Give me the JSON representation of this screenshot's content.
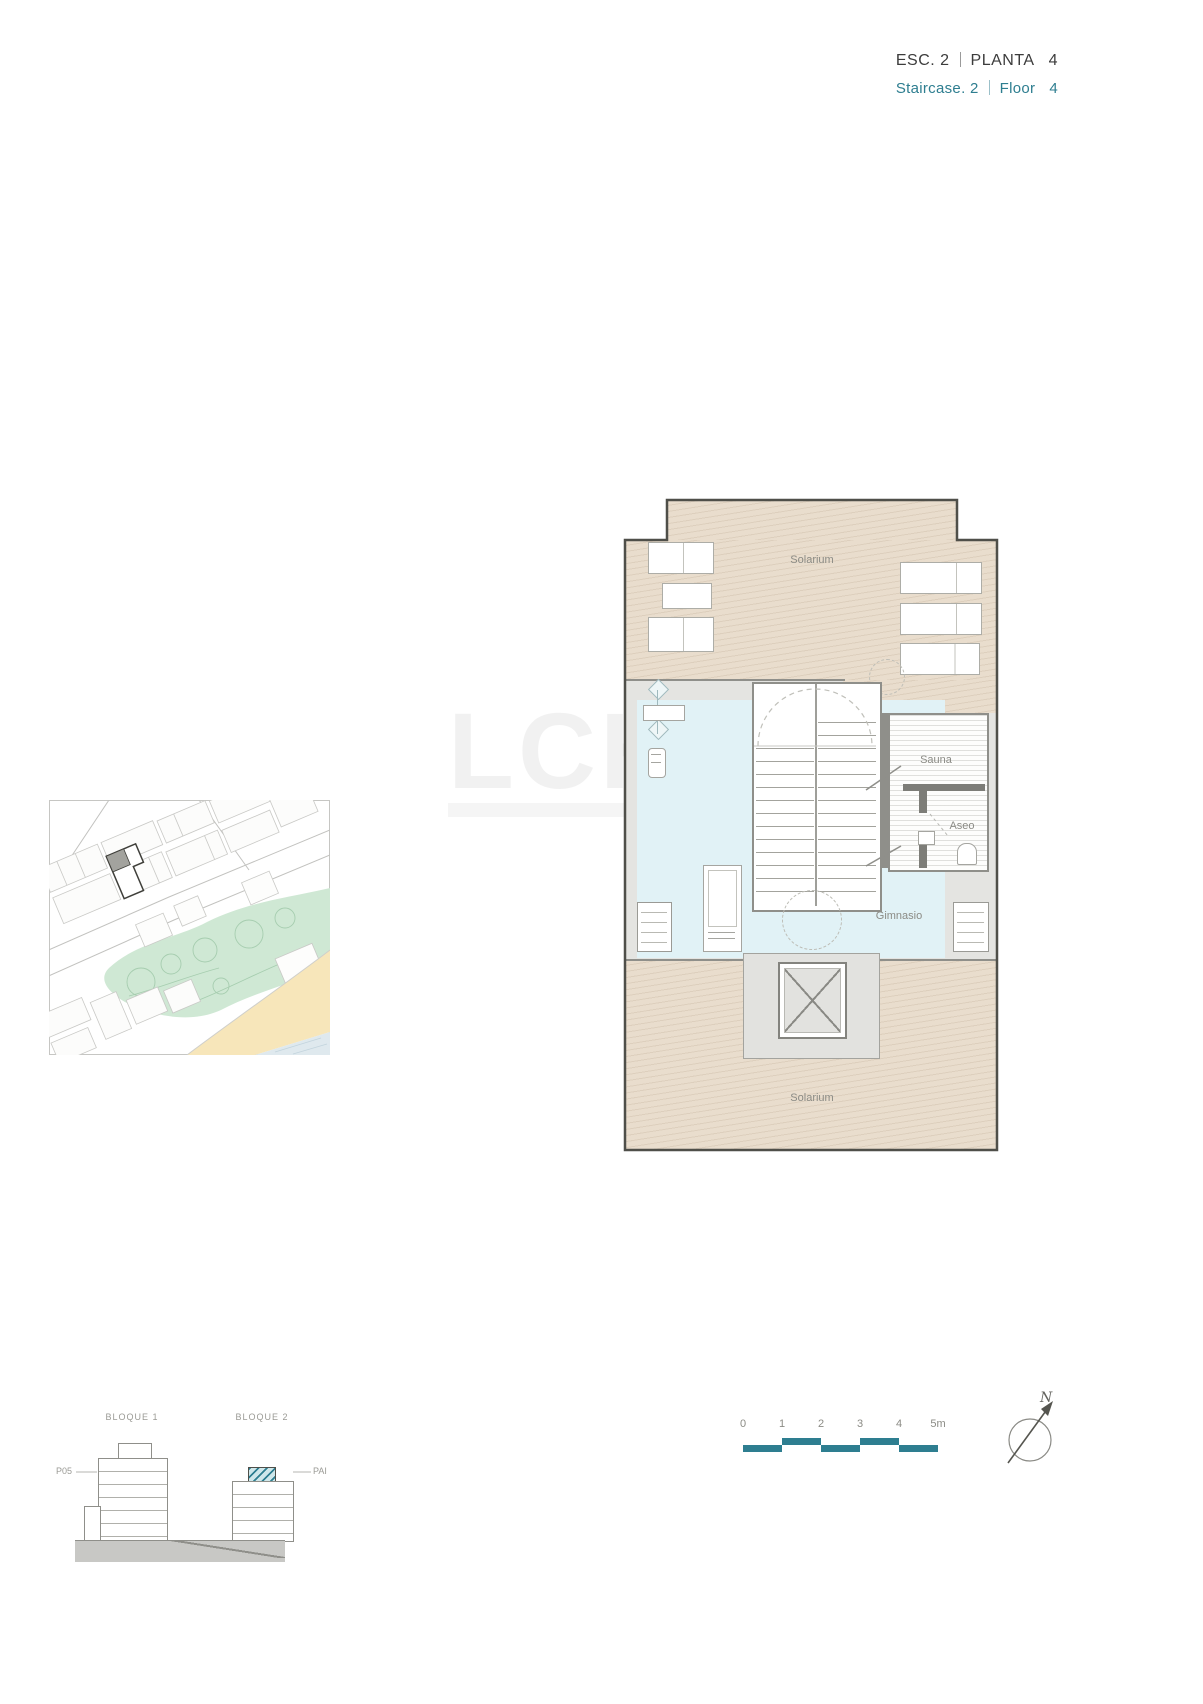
{
  "header": {
    "esc_label": "ESC. 2",
    "planta_label": "PLANTA",
    "planta_number": "4",
    "staircase_label": "Staircase. 2",
    "floor_label": "Floor",
    "floor_number": "4",
    "accent_color": "#2e7e90"
  },
  "floor_plan": {
    "rooms": {
      "solarium_top": "Solarium",
      "sauna": "Sauna",
      "aseo": "Aseo",
      "gimnasio": "Gimnasio",
      "solarium_bottom": "Solarium"
    }
  },
  "watermark": {
    "text": "LCH"
  },
  "elevations": {
    "bloque1_label": "BLOQUE 1",
    "bloque2_label": "BLOQUE 2",
    "left_floor_label": "P05",
    "right_floor_label": "PAI",
    "highlight_color": "#2e7e90"
  },
  "scale_bar": {
    "ticks": [
      "0",
      "1",
      "2",
      "3",
      "4",
      "5m"
    ],
    "color": "#2e7e90"
  },
  "compass": {
    "label": "N"
  },
  "colors": {
    "solarium_fill": "#e9ddcd",
    "gym_fill": "#e1f2f6",
    "wall_fill": "#e4e4e1",
    "outline": "#4f4f49",
    "label_text": "#8b8b85"
  }
}
